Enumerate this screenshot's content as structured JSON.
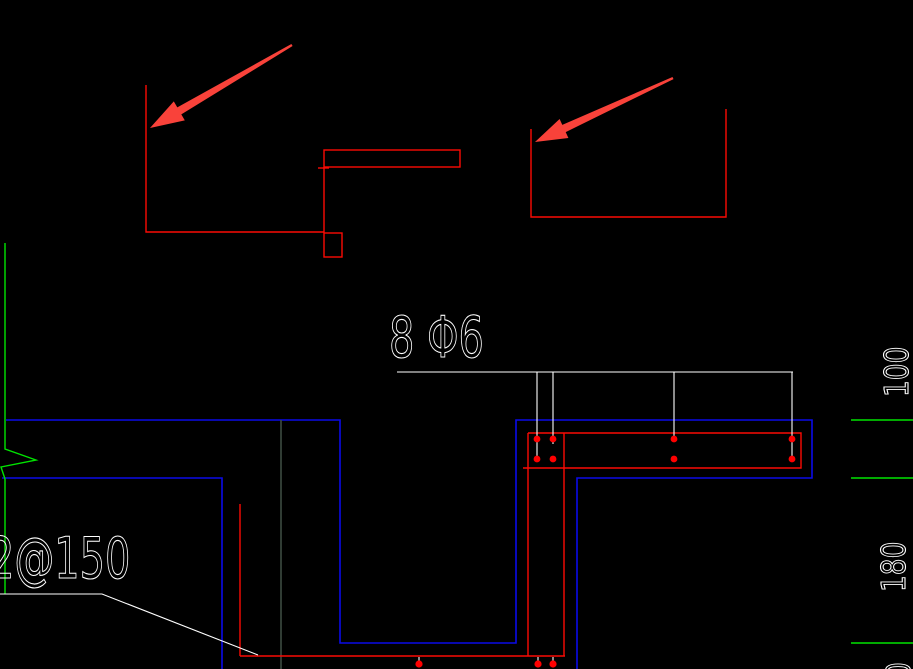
{
  "canvas": {
    "width": 913,
    "height": 669,
    "background": "#000000"
  },
  "colors": {
    "red": "#fb0a04",
    "blue": "#0a0ae8",
    "green": "#00e400",
    "white": "#ffffff",
    "gray_grid": "#3c4c42",
    "arrow": "#f9423a",
    "dot": "#ff0000",
    "bg": "#000000"
  },
  "labels": {
    "rebar_count_label": "8 Φ6",
    "spacing_label": "2@150",
    "dim_top": "100",
    "dim_middle": "180",
    "dim_bottom_partial": "0"
  }
}
